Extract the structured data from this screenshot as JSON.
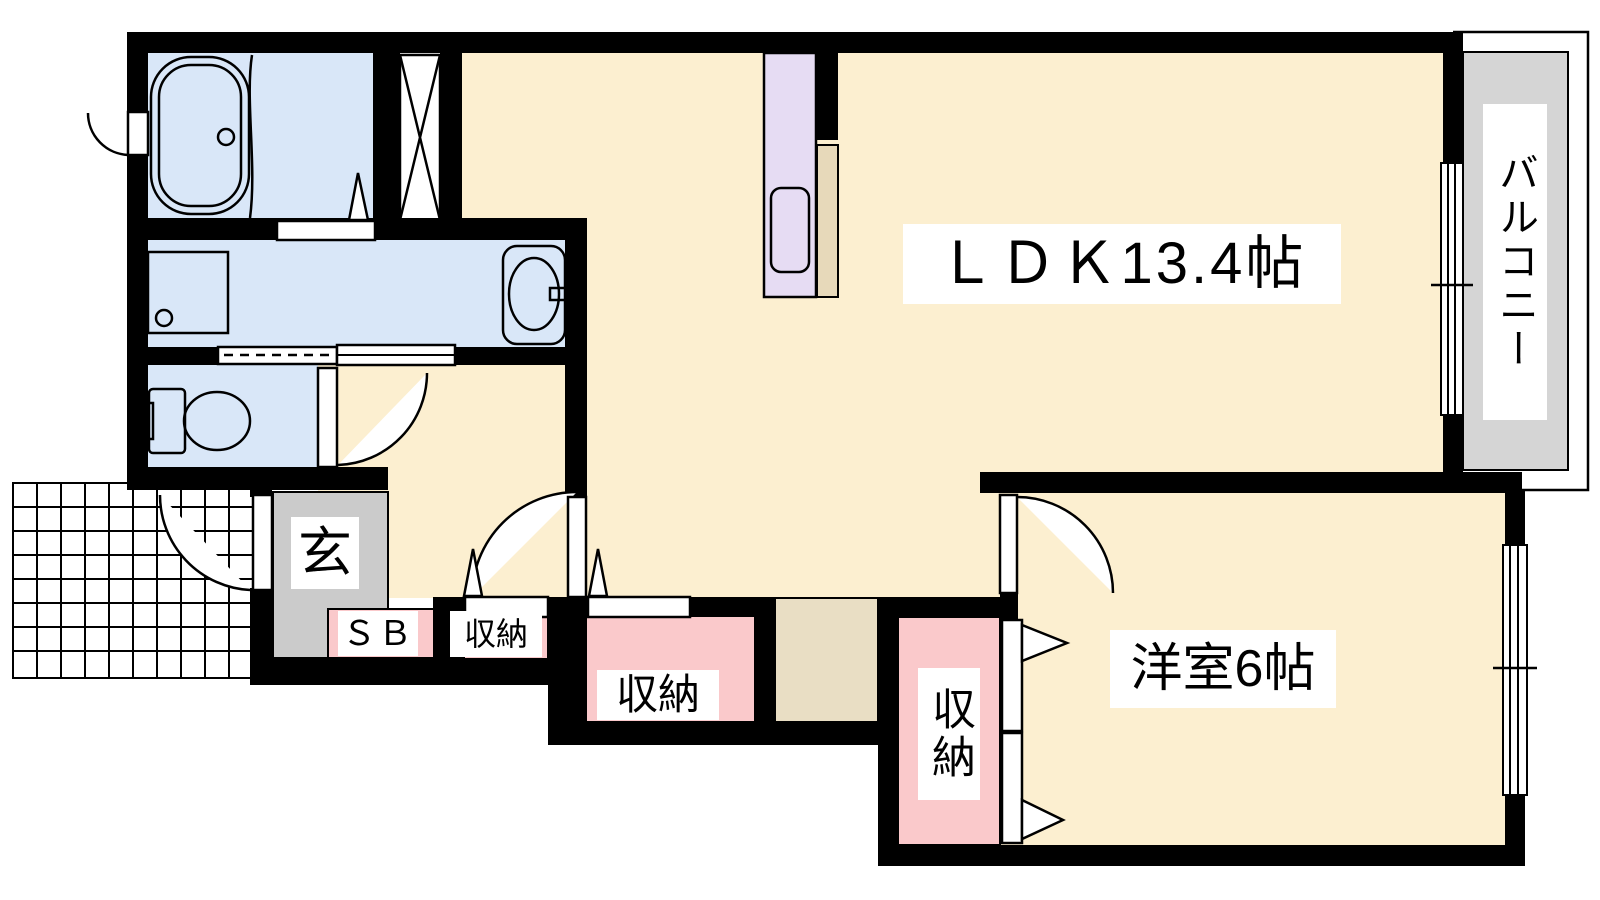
{
  "title": "1LDK floor plan",
  "rooms": {
    "ldk": {
      "label": "ＬＤＫ13.4帖"
    },
    "western_room": {
      "label": "洋室6帖"
    },
    "balcony": {
      "label": "バルコニー"
    },
    "entrance": {
      "label": "玄"
    },
    "shoe_box": {
      "label": "ＳＢ"
    },
    "closet_hall_small": {
      "label": "収納"
    },
    "closet_hall_large": {
      "label": "収納"
    },
    "closet_western_room": {
      "label": "収納"
    }
  },
  "fixtures": [
    "bathtub",
    "washing-machine-pan",
    "vanity-sink",
    "toilet",
    "kitchen-counter-sink",
    "pipe-space",
    "entrance-porch-tiles",
    "sliding-window-ldk",
    "sliding-window-western-room",
    "swing-doors",
    "folding-closet-doors"
  ],
  "colors": {
    "wall": "#000000",
    "room_beige": "#fcefd0",
    "wet_area_blue": "#d9e7f8",
    "kitchen_purple": "#e6dcf3",
    "closet_pink": "#fac9cb",
    "entrance_gray": "#cbcbcb",
    "balcony_gray": "#d5d5d5",
    "step_tan": "#e9dec4",
    "counter_tan": "#e7d9ba"
  }
}
